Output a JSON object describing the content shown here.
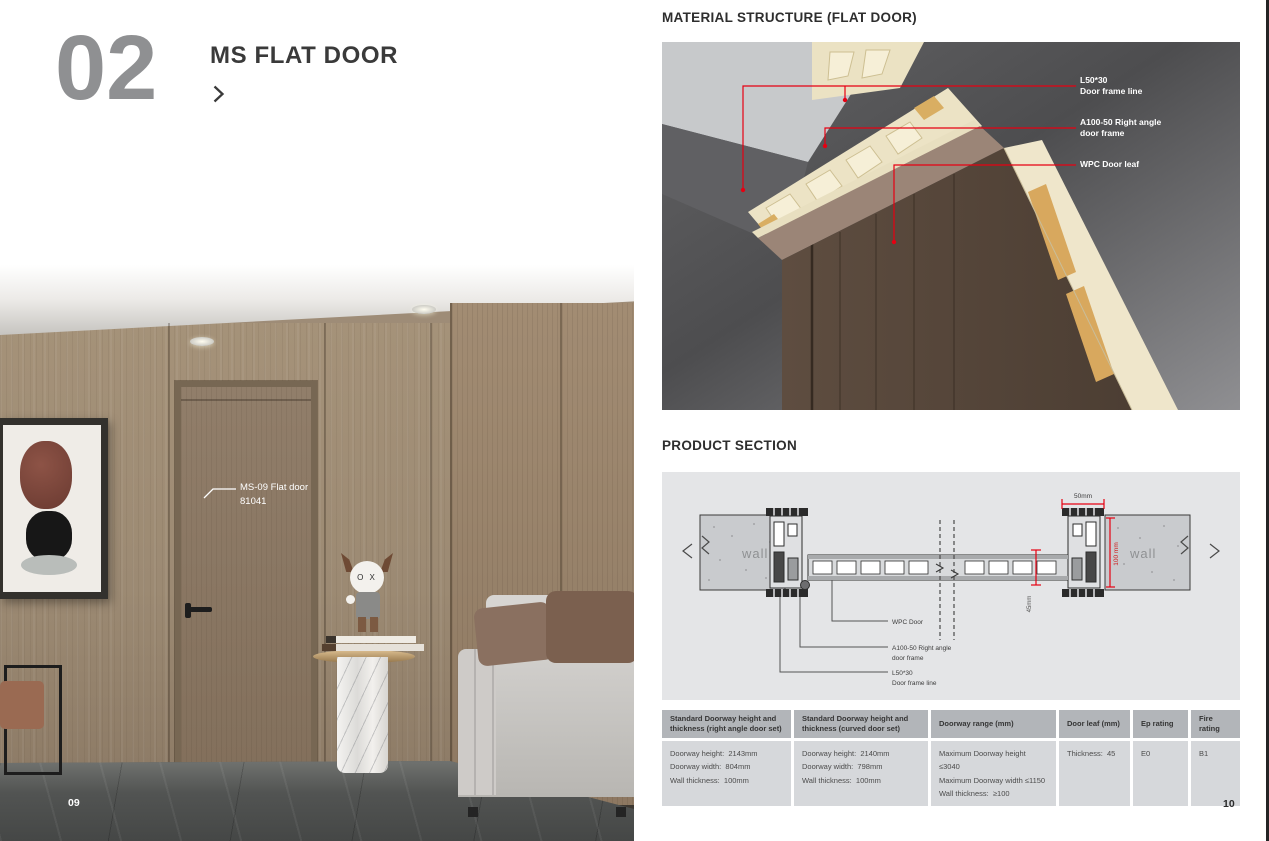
{
  "page": {
    "left_number": "09",
    "right_number": "10"
  },
  "left": {
    "chapter_number": "02",
    "title": "MS FLAT DOOR",
    "photo_label": {
      "line1": "MS-09 Flat door",
      "line2": "81041"
    },
    "figurine_face": "O X"
  },
  "right": {
    "material_structure": {
      "heading": "MATERIAL STRUCTURE (FLAT DOOR)",
      "annotations": [
        {
          "line1": "L50*30",
          "line2": "Door frame line"
        },
        {
          "line1": "A100-50 Right angle",
          "line2": "door frame"
        },
        {
          "line1": "WPC Door leaf",
          "line2": ""
        }
      ]
    },
    "product_section": {
      "heading": "PRODUCT SECTION",
      "labels": {
        "wall_left": "wall",
        "wall_right": "wall",
        "dim_width": "50mm",
        "dim_depth": "100 mm",
        "dim_thickness": "45mm",
        "callout_wpc": "WPC Door",
        "callout_frame_line1": "A100-50 Right angle",
        "callout_frame_line2": "door frame",
        "callout_line_line1": "L50*30",
        "callout_line_line2": "Door frame line"
      }
    },
    "table": {
      "columns": [
        {
          "header": "Standard Doorway height and thickness (right angle door set)",
          "lines": [
            "Doorway height:  2143mm",
            "Doorway width:  804mm",
            "Wall thickness:  100mm"
          ]
        },
        {
          "header": "Standard Doorway height and thickness (curved door set)",
          "lines": [
            "Doorway height:  2140mm",
            "Doorway width:  798mm",
            "Wall thickness:  100mm"
          ]
        },
        {
          "header": "Doorway range (mm)",
          "lines": [
            "Maximum Doorway height ≤3040",
            "Maximum Doorway width ≤1150",
            "Wall thickness:  ≥100"
          ]
        },
        {
          "header": "Door leaf (mm)",
          "lines": [
            "Thickness:  45"
          ]
        },
        {
          "header": "Ep rating",
          "lines": [
            "E0"
          ]
        },
        {
          "header": "Fire rating",
          "lines": [
            "B1"
          ]
        }
      ]
    }
  },
  "colors": {
    "accent_red": "#e60012"
  }
}
